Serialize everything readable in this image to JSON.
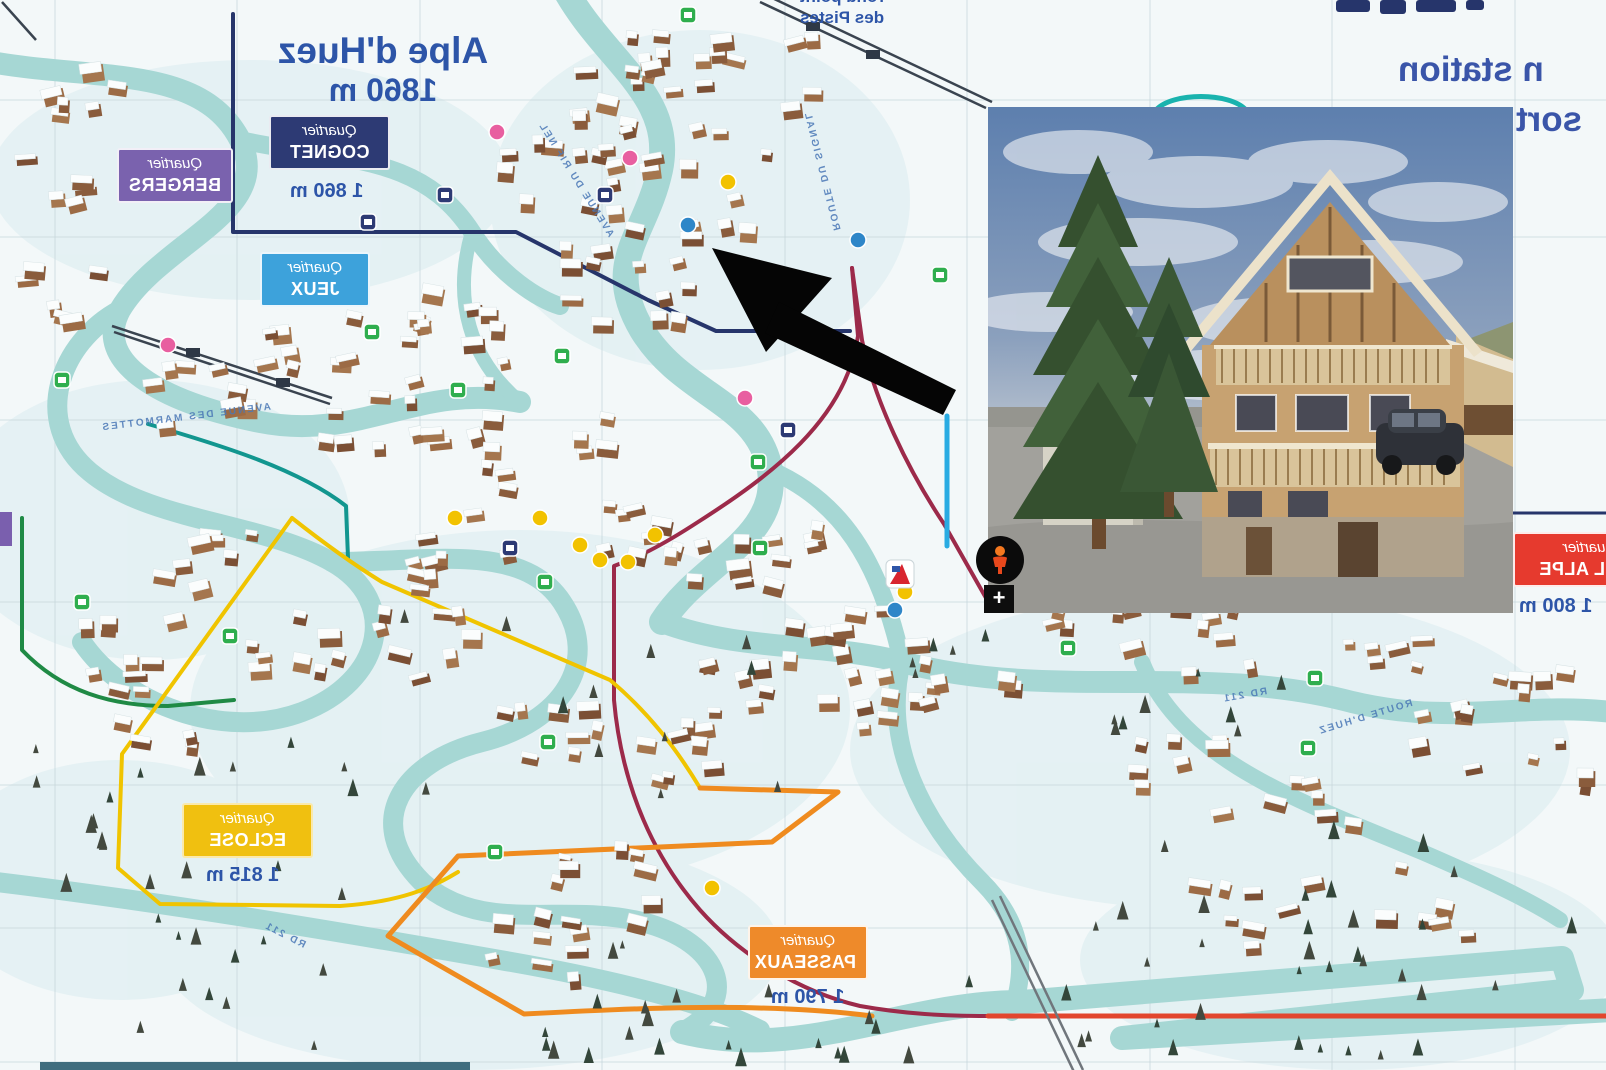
{
  "header": {
    "station_text": "n station",
    "resort_text": "sort",
    "color": "#3a55a9"
  },
  "map_title": {
    "line1": "Alpe d'Huez",
    "line2": "1860 m",
    "color": "#2d55a8"
  },
  "poi_label": {
    "line1": "rond point",
    "line2": "des Pistes"
  },
  "districts": [
    {
      "id": "bergers",
      "prefix": "Quartier",
      "name": "BERGERS",
      "bg": "#7a62ae",
      "altitude": ""
    },
    {
      "id": "cognet",
      "prefix": "Quartier",
      "name": "COGNET",
      "bg": "#2d3a74",
      "altitude": "1 860 m"
    },
    {
      "id": "jeux",
      "prefix": "Quartier",
      "name": "JEUX",
      "bg": "#3da2db",
      "altitude": ""
    },
    {
      "id": "eclose",
      "prefix": "Quartier",
      "name": "ECLOSE",
      "bg": "#f0c010",
      "altitude": "1 815 m"
    },
    {
      "id": "passeaux",
      "prefix": "Quartier",
      "name": "PASSEAUX",
      "bg": "#ee8a2a",
      "altitude": "1 790 m"
    },
    {
      "id": "vieil-alpe",
      "prefix": "Quartier",
      "name": "VIEIL ALPE",
      "bg": "#e63a2e",
      "altitude": "1 800 m"
    }
  ],
  "roads": [
    {
      "name": "AVENUE DU RIF NEL"
    },
    {
      "name": "AVENUE DES MARMOTTES"
    },
    {
      "name": "ROUTE DU SIGNAL"
    },
    {
      "name": "RD 211"
    },
    {
      "name": "ROUTE D'HUEZ"
    },
    {
      "name": "RD 211"
    }
  ],
  "street_view": {
    "zoom_in_label": "+"
  },
  "map_colors": {
    "road_teal": "#a6d7d4",
    "boundary_navy": "#26356b",
    "boundary_crimson": "#9c2a4a",
    "boundary_red": "#e2462e",
    "boundary_yellow": "#f0c400",
    "boundary_orange": "#ef8b1f",
    "boundary_green": "#1f8a45",
    "boundary_teal": "#12968f",
    "boundary_blue": "#29abe2",
    "arrow_black": "#050505"
  }
}
